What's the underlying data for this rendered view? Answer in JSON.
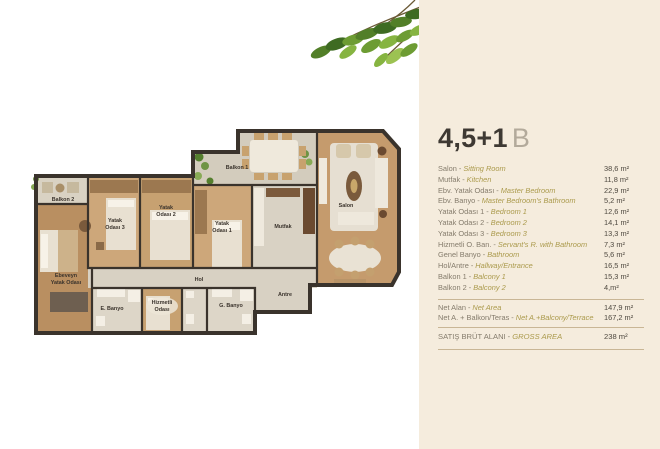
{
  "panel": {
    "title": "4,5+1",
    "title_suffix": "B",
    "separator": "-",
    "rooms": [
      {
        "tr": "Salon",
        "en": "Sitting Room",
        "area": "38,6 m²"
      },
      {
        "tr": "Mutfak",
        "en": "Kitchen",
        "area": "11,8 m²"
      },
      {
        "tr": "Ebv. Yatak Odası",
        "en": "Master Bedroom",
        "area": "22,9 m²"
      },
      {
        "tr": "Ebv. Banyo",
        "en": "Master Bedroom's Bathroom",
        "area": "5,2 m²"
      },
      {
        "tr": "Yatak Odası 1",
        "en": "Bedroom 1",
        "area": "12,6 m²"
      },
      {
        "tr": "Yatak Odası 2",
        "en": "Bedroom 2",
        "area": "14,1 m²"
      },
      {
        "tr": "Yatak Odası 3",
        "en": "Bedroom 3",
        "area": "13,3 m²"
      },
      {
        "tr": "Hizmetli O. Ban.",
        "en": "Servant's R. with Bathroom",
        "area": "7,3 m²"
      },
      {
        "tr": "Genel Banyo",
        "en": "Bathroom",
        "area": "5,6 m²"
      },
      {
        "tr": "Hol/Antre",
        "en": "Hallway/Entrance",
        "area": "16,5 m²"
      },
      {
        "tr": "Balkon 1",
        "en": "Balcony 1",
        "area": "15,3 m²"
      },
      {
        "tr": "Balkon 2",
        "en": "Balcony 2",
        "area": "4,m²"
      }
    ],
    "totals": [
      {
        "tr": "Net Alan",
        "en": "Net Area",
        "area": "147,9 m²"
      },
      {
        "tr": "Net A. + Balkon/Teras",
        "en": "Net A.+Balcony/Terrace",
        "area": "167,2 m²"
      }
    ],
    "gross": {
      "tr": "SATIŞ BRÜT ALANI",
      "en": "GROSS AREA",
      "area": "238 m²"
    }
  },
  "floorplan": {
    "labels": {
      "balkon2": "Balkon 2",
      "yatak3_1": "Yatak",
      "yatak3_2": "Odası 3",
      "yatak2_1": "Yatak",
      "yatak2_2": "Odası 2",
      "yatak1_1": "Yatak",
      "yatak1_2": "Odası 1",
      "balkon1": "Balkon 1",
      "mutfak": "Mutfak",
      "salon": "Salon",
      "ebeveyn_1": "Ebeveyn",
      "ebeveyn_2": "Yatak Odası",
      "hol": "Hol",
      "e_banyo": "E. Banyo",
      "hizmetli_1": "Hizmetli",
      "hizmetli_2": "Odası",
      "g_banyo": "G. Banyo",
      "antre": "Antre"
    }
  },
  "colors": {
    "panel_bg": "#f5ecdd",
    "divider": "#c9b695",
    "title": "#3e3933",
    "title_suffix": "#b3aa9b",
    "label_tr": "#857c6c",
    "label_en_italic": "#ab9a4c",
    "value": "#4e483f",
    "plan_wall": "#3a332c",
    "plan_wood": "#c7a171",
    "plan_tile": "#d8d1c3",
    "leaf_green": "#6d9c33"
  }
}
